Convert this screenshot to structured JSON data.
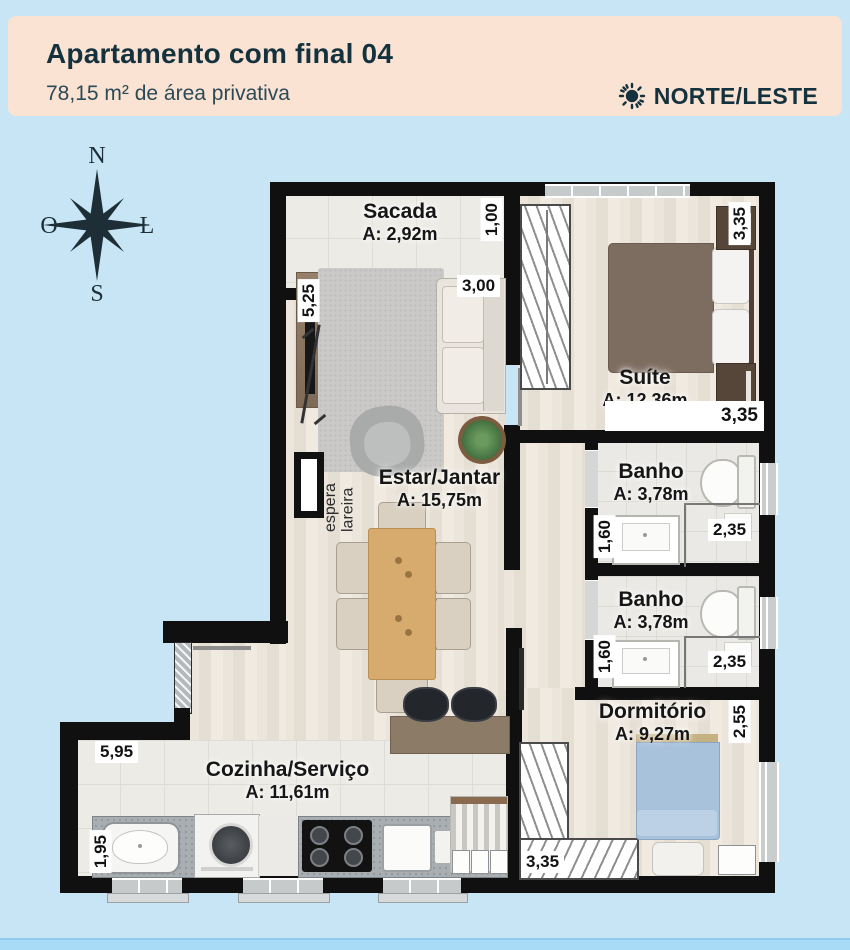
{
  "header": {
    "title": "Apartamento com final 04",
    "subtitle": "78,15 m² de área privativa",
    "orientation_label": "NORTE/LESTE"
  },
  "compass": {
    "north": "N",
    "south": "S",
    "west": "O",
    "east": "L"
  },
  "rooms": {
    "sacada": {
      "name": "Sacada",
      "area": "A: 2,92m"
    },
    "suite": {
      "name": "Suíte",
      "area": "A: 12,36m"
    },
    "estar": {
      "name": "Estar/Jantar",
      "area": "A: 15,75m"
    },
    "banho1": {
      "name": "Banho",
      "area": "A: 3,78m"
    },
    "banho2": {
      "name": "Banho",
      "area": "A: 3,78m"
    },
    "dormitorio": {
      "name": "Dormitório",
      "area": "A: 9,27m"
    },
    "cozinha": {
      "name": "Cozinha/Serviço",
      "area": "A: 11,61m"
    }
  },
  "dims": {
    "sacada_depth": "1,00",
    "estar_width": "3,00",
    "estar_height": "5,25",
    "suite_side": "3,35",
    "suite_bottom": "3,35",
    "banho1_left": "1,60",
    "banho1_bottom": "2,35",
    "banho2_left": "1,60",
    "banho2_bottom": "2,35",
    "dorm_right": "2,55",
    "dorm_bottom": "3,35",
    "cozinha_top": "5,95",
    "cozinha_left": "1,95"
  },
  "annotations": {
    "fireplace_line1": "espera",
    "fireplace_line2": "lareira"
  },
  "colors": {
    "page_bg": "#c7e5f4",
    "footer_bg": "#a8dcf6",
    "header_bg": "#fbe3d4",
    "header_text": "#14323e",
    "wall": "#101010"
  }
}
